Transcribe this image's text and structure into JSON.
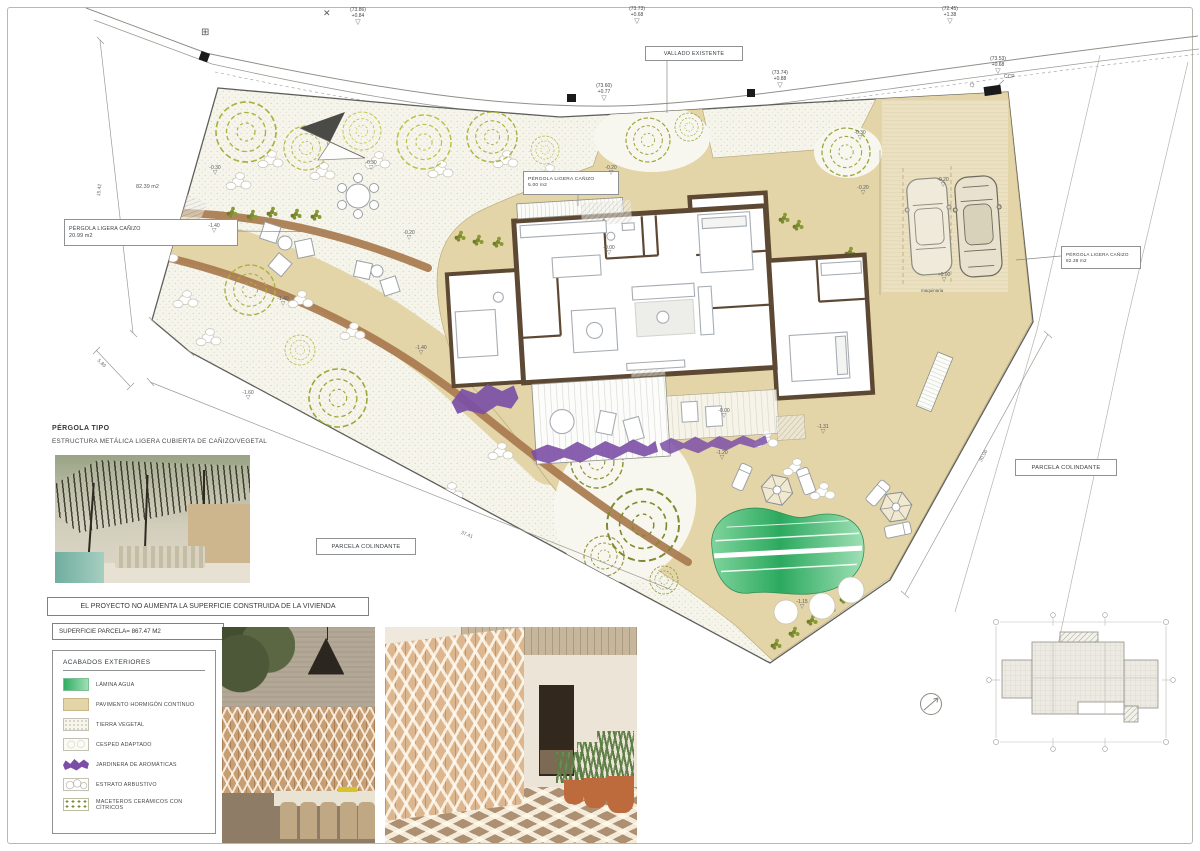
{
  "icons": {
    "tri": "▽",
    "utility": "⊞",
    "benchmark": "✕",
    "sun": "☼"
  },
  "street_markers": [
    {
      "l1": "(73.86)",
      "l2": "+0.84"
    },
    {
      "l1": "(73.73)",
      "l2": "+0.68"
    },
    {
      "l1": "(72.45)",
      "l2": "+1.38"
    },
    {
      "l1": "(73.60)",
      "l2": "+0.77"
    },
    {
      "l1": "(73.74)",
      "l2": "+0.88"
    },
    {
      "l1": "(73.53)",
      "l2": "+0.68"
    }
  ],
  "labels": {
    "vallado": "VALLADO EXISTENTE",
    "ccp": "CCP",
    "maquinaria": "maquinaria",
    "area_street": "82.39 m2",
    "parcela": "PARCELA COLINDANTE",
    "pergola_line1": "PÉRGOLA LIGERA CAÑIZO",
    "pergola_left_m2": "20.99 m2",
    "pergola_center_m2": "5.00 m2",
    "pergola_right_m2": "82.38 m2"
  },
  "levels": [
    "-0.30",
    "-1.40",
    "-1.40",
    "-0.30",
    "-0.20",
    "-0.20",
    "-0.30",
    "-0.20",
    "-0.20",
    "+0.00",
    "-0.00",
    "-0.00",
    "-1.31",
    "-1.20",
    "-1.15",
    "-1.40",
    "-1.60"
  ],
  "dims": {
    "left": "15.42",
    "left2": "5.89",
    "bottom": "37.41",
    "right": "30.06"
  },
  "pergola_info": {
    "title": "PÉRGOLA TIPO",
    "subtitle": "ESTRUCTURA METÁLICA LIGERA CUBIERTA DE CAÑIZO/VEGETAL"
  },
  "notes": {
    "project": "EL PROYECTO NO AUMENTA LA SUPERFICIE CONSTRUIDA DE LA VIVIENDA",
    "surface": "SUPERFICIE PARCELA= 867.47 M2"
  },
  "legend": {
    "title": "ACABADOS  EXTERIORES",
    "items": [
      "LÁMINA AGUA",
      "PAVIMENTO HORMIGÓN CONTÍNUO",
      "TIERRA VEGETAL",
      "CESPED ADAPTADO",
      "JARDINERA  DE AROMÁTICAS",
      "ESTRATO ARBUSTIVO",
      "MACETEROS CERÁMICOS CON CÍTRICOS"
    ]
  },
  "colors": {
    "paving": "#e4d5a8",
    "water_dark": "#2fae62",
    "water_light": "#9fe0b5",
    "aromatics": "#7b4fa6",
    "wall": "#5d4833",
    "path_band": "#a87a4e"
  }
}
